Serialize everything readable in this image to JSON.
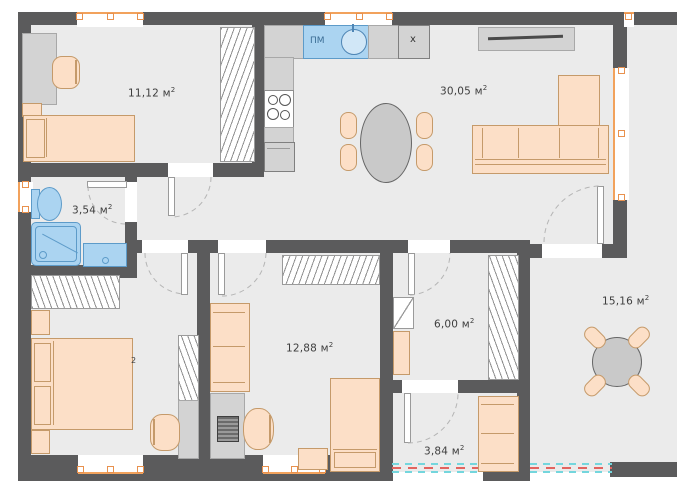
{
  "floor_plan": {
    "rooms": {
      "kids_room": {
        "area": "11,12 м",
        "sup": "2"
      },
      "living_kitchen": {
        "area": "30,05 м",
        "sup": "2"
      },
      "bathroom": {
        "area": "3,54 м",
        "sup": "2"
      },
      "bedroom": {
        "visible_sup": "2"
      },
      "bedroom2": {
        "area": "12,88 м",
        "sup": "2"
      },
      "hallway": {
        "area": "6,00 м",
        "sup": "2"
      },
      "terrace": {
        "area": "15,16 м",
        "sup": "2"
      },
      "porch": {
        "area": "3,84 м",
        "sup": "2"
      }
    },
    "kitchen": {
      "dishwasher": "ПМ",
      "unit": "x"
    },
    "colors": {
      "wall": "#5b5b5c",
      "floor": "#ebebeb",
      "furniture": "#fcdfc7",
      "plumbing": "#abd4f1",
      "window_accent": "#f2a25c",
      "boundary_red": "#e2645f",
      "boundary_cyan": "#74d6dd"
    }
  }
}
